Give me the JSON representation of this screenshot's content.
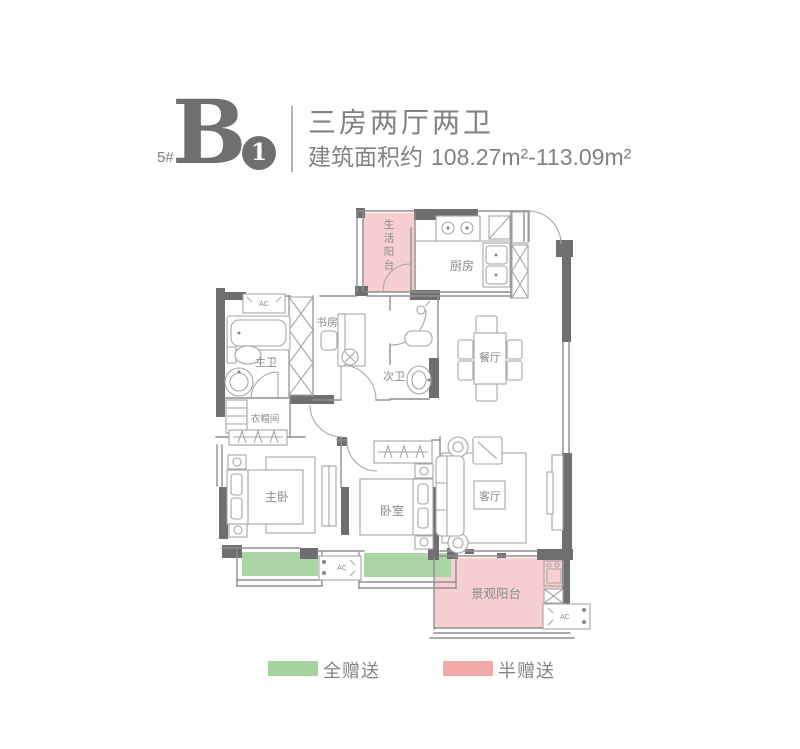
{
  "header": {
    "block_number": "5#",
    "unit_letter": "B",
    "unit_number": "1",
    "title": "三房两厅两卫",
    "area_label": "建筑面积约",
    "area_value": "108.27m²-113.09m²"
  },
  "floorplan": {
    "rooms": {
      "service_balcony": "生活阳台",
      "kitchen": "厨房",
      "dining": "餐厅",
      "master_bath": "主卫",
      "second_bath": "次卫",
      "study": "书房",
      "cloakroom": "衣帽间",
      "master_bedroom": "主卧",
      "bedroom": "卧室",
      "living": "客厅",
      "view_balcony": "景观阳台"
    },
    "ac_label": "AC",
    "colors": {
      "full_gift_green": "#abd5a5",
      "half_gift_pink": "#f7cfd0",
      "wall_dark": "#6f6f71",
      "line_gray": "#8f8f91",
      "text_gray": "#8a8a8c"
    }
  },
  "legend": {
    "items": [
      {
        "label": "全赠送",
        "color": "#a6d29e"
      },
      {
        "label": "半赠送",
        "color": "#f2a9a9"
      }
    ]
  }
}
